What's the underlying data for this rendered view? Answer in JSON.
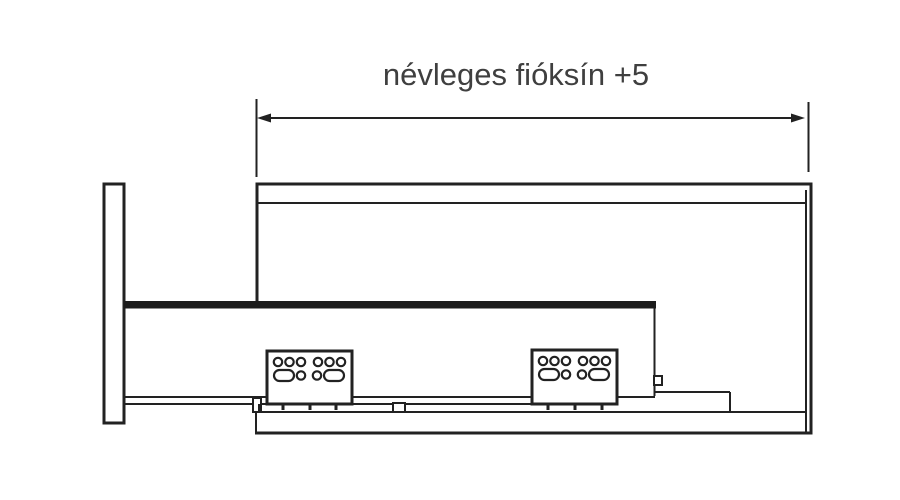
{
  "diagram": {
    "type": "technical-drawing",
    "title": "névleges fióksín +5",
    "dimension": {
      "label": "névleges fióksín +5",
      "style": "double-ended-arrow"
    },
    "components": {
      "front_panel": "drawer front panel (side view)",
      "cabinet": "cabinet carcass outline with back and bottom panels",
      "rail": "drawer slide rail (thick bar)",
      "brackets": "two perforated mounting brackets",
      "lower_rail": "lower slide profile with tick marks"
    },
    "colors": {
      "line": "#222222",
      "rail": "#1c1c1c",
      "text": "#3f3f3f",
      "background": "#ffffff"
    }
  }
}
